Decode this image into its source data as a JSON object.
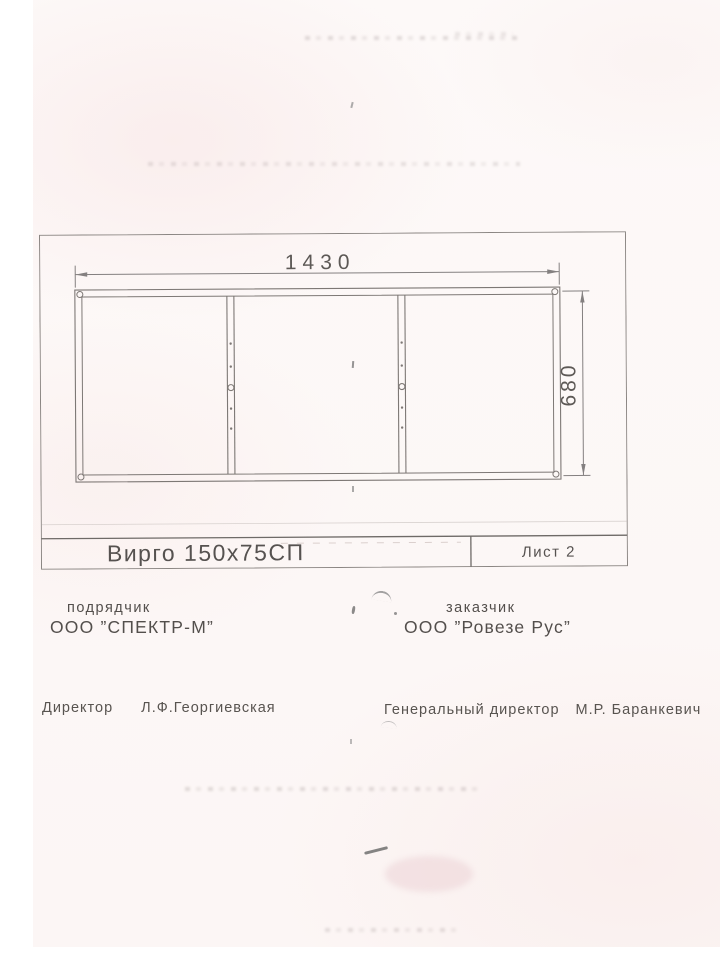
{
  "document": {
    "kind": "scanned technical drawing sheet",
    "paper_tint": "#fcf7f6",
    "line_color": "#7d7875",
    "text_color": "#534f4c"
  },
  "drawing": {
    "dim_width": "1430",
    "dim_height": "680",
    "title": "Вирго 150х75СП",
    "sheet_label": "Лист 2"
  },
  "parties": {
    "contractor_label": "подрядчик",
    "contractor_name": "ООО ”СПЕКТР-М”",
    "customer_label": "заказчик",
    "customer_name": "ООО ”Ровезе Рус”"
  },
  "signatures": {
    "director_title": "Директор",
    "director_name": "Л.Ф.Георгиевская",
    "gen_director_title": "Генеральный директор",
    "gen_director_name": "М.Р. Баранкевич"
  }
}
